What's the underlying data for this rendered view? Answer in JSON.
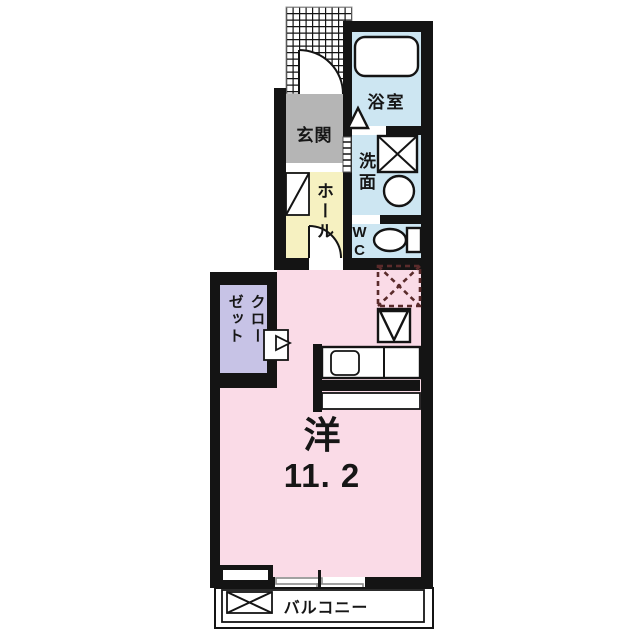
{
  "title": "apartment floor plan",
  "colors": {
    "wall": "#141414",
    "wet": "#cde6f2",
    "genkan": "#b5b5b5",
    "hall": "#f6f1c1",
    "closet": "#c7c3e6",
    "room": "#fadbe7",
    "dash": "#5a2b2b"
  },
  "rooms": {
    "bath": {
      "label": "浴室"
    },
    "washroom": {
      "label": "洗面"
    },
    "wc": {
      "label": "WC"
    },
    "genkan": {
      "label": "玄関"
    },
    "hall": {
      "label": "ホール"
    },
    "closet": {
      "label_col_right": "クロー",
      "label_col_left": "ゼット"
    },
    "main_room": {
      "name": "洋",
      "area": "11. 2"
    },
    "balcony": {
      "label": "バルコニー"
    }
  },
  "symbols": {
    "porch": "hatched-entrance-porch",
    "entrance_door": "quarter-arc-door",
    "bath_door": "triangle-folding-door",
    "washer_pan": "x-box",
    "washbasin": "circle",
    "toilet": "ellipse-with-tank",
    "refrigerator_space": "dashed-x-box",
    "water_heater": "inverted-triangle-box",
    "kitchen_sink": "rounded-square",
    "balcony_equipment": "x-box",
    "window": "double-line-sliding"
  }
}
